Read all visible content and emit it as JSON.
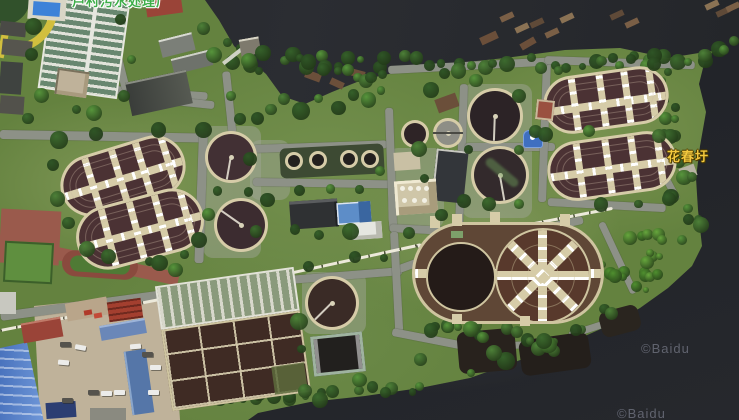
{
  "map": {
    "view": "satellite",
    "labels": [
      {
        "id": "top-clipped-label",
        "text": "芦村污水处理厂",
        "color": "#3fae4a",
        "style": "green-with-white-halo",
        "clipped": "top edge"
      },
      {
        "id": "huachunwei-label",
        "text": "花春圩",
        "color": "#f2c83e",
        "style": "gold-with-dark-halo"
      }
    ],
    "watermarks": [
      {
        "text": "©Baidu"
      },
      {
        "text": "©Baidu"
      }
    ],
    "colors": {
      "water": "#25272c",
      "vegetation_dark": "#2f5526",
      "vegetation_bright": "#57953c",
      "grass_base": "#64823f",
      "road": "#8d9187",
      "walkway_tan": "#d6cca8",
      "tank_interior": "#44302f",
      "tank_dark": "#2a2221",
      "aeration_teal": "#68876f",
      "brick_red": "#9a5a4c",
      "roof_blue": "#4a6fae",
      "roof_red": "#9a4438",
      "pool_blue": "#3d82d8",
      "concrete": "#bfb29a"
    }
  }
}
